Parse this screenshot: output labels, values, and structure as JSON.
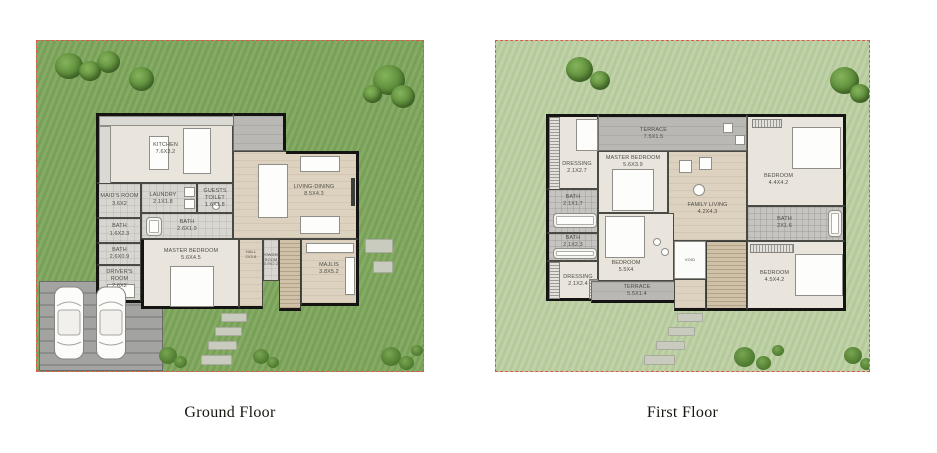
{
  "captions": {
    "ground": "Ground Floor",
    "first": "First Floor"
  },
  "colors": {
    "plot_border": "#dd5950",
    "ground_lawn": "#7ea75c",
    "first_lawn": "#bccfa2",
    "wall": "#141412",
    "floor_beige": "#eae5dc",
    "floor_wood": "#ddd2c0",
    "terrace_gray": "#b9b8b4",
    "garage_gray": "#9c9c9a",
    "tree_green": "#5c8c39"
  },
  "ground_floor": {
    "rooms": [
      {
        "name": "KITCHEN",
        "dim": "7.6X3.2"
      },
      {
        "name": "MAID'S ROOM",
        "dim": "3.6X2"
      },
      {
        "name": "BATH",
        "dim": "1.6X2.3"
      },
      {
        "name": "BATH",
        "dim": "2.6X0.9"
      },
      {
        "name": "DRIVER'S ROOM",
        "dim": "2.6X2"
      },
      {
        "name": "LAUNDRY",
        "dim": "2.1X1.8"
      },
      {
        "name": "GUESTS TOILET",
        "dim": "1.6X1.8"
      },
      {
        "name": "BATH",
        "dim": "2.6X1.9"
      },
      {
        "name": "MASTER BEDROOM",
        "dim": "5.6X4.5"
      },
      {
        "name": "HALL",
        "dim": "2X3.8"
      },
      {
        "name": "POWDER ROOM",
        "dim": "0.9X2.2"
      },
      {
        "name": "MAJLIS",
        "dim": "3.8X5.2"
      },
      {
        "name": "LIVING-DINING",
        "dim": "8.5X4.3"
      }
    ]
  },
  "first_floor": {
    "rooms": [
      {
        "name": "TERRACE",
        "dim": "7.5X1.5"
      },
      {
        "name": "DRESSING",
        "dim": "2.1X2.7"
      },
      {
        "name": "MASTER BEDROOM",
        "dim": "5.6X3.9"
      },
      {
        "name": "BATH",
        "dim": "2.1X1.7"
      },
      {
        "name": "BATH",
        "dim": "2.1X2.3"
      },
      {
        "name": "DRESSING",
        "dim": "2.1X2.4"
      },
      {
        "name": "BEDROOM",
        "dim": "5.5X4"
      },
      {
        "name": "TERRACE",
        "dim": "5.5X1.4"
      },
      {
        "name": "VOID",
        "dim": ""
      },
      {
        "name": "FAMILY LIVING",
        "dim": "4.2X4.3"
      },
      {
        "name": "BEDROOM",
        "dim": "4.4X4.2"
      },
      {
        "name": "BATH",
        "dim": "2X1.6"
      },
      {
        "name": "BEDROOM",
        "dim": "4.5X4.2"
      }
    ]
  }
}
